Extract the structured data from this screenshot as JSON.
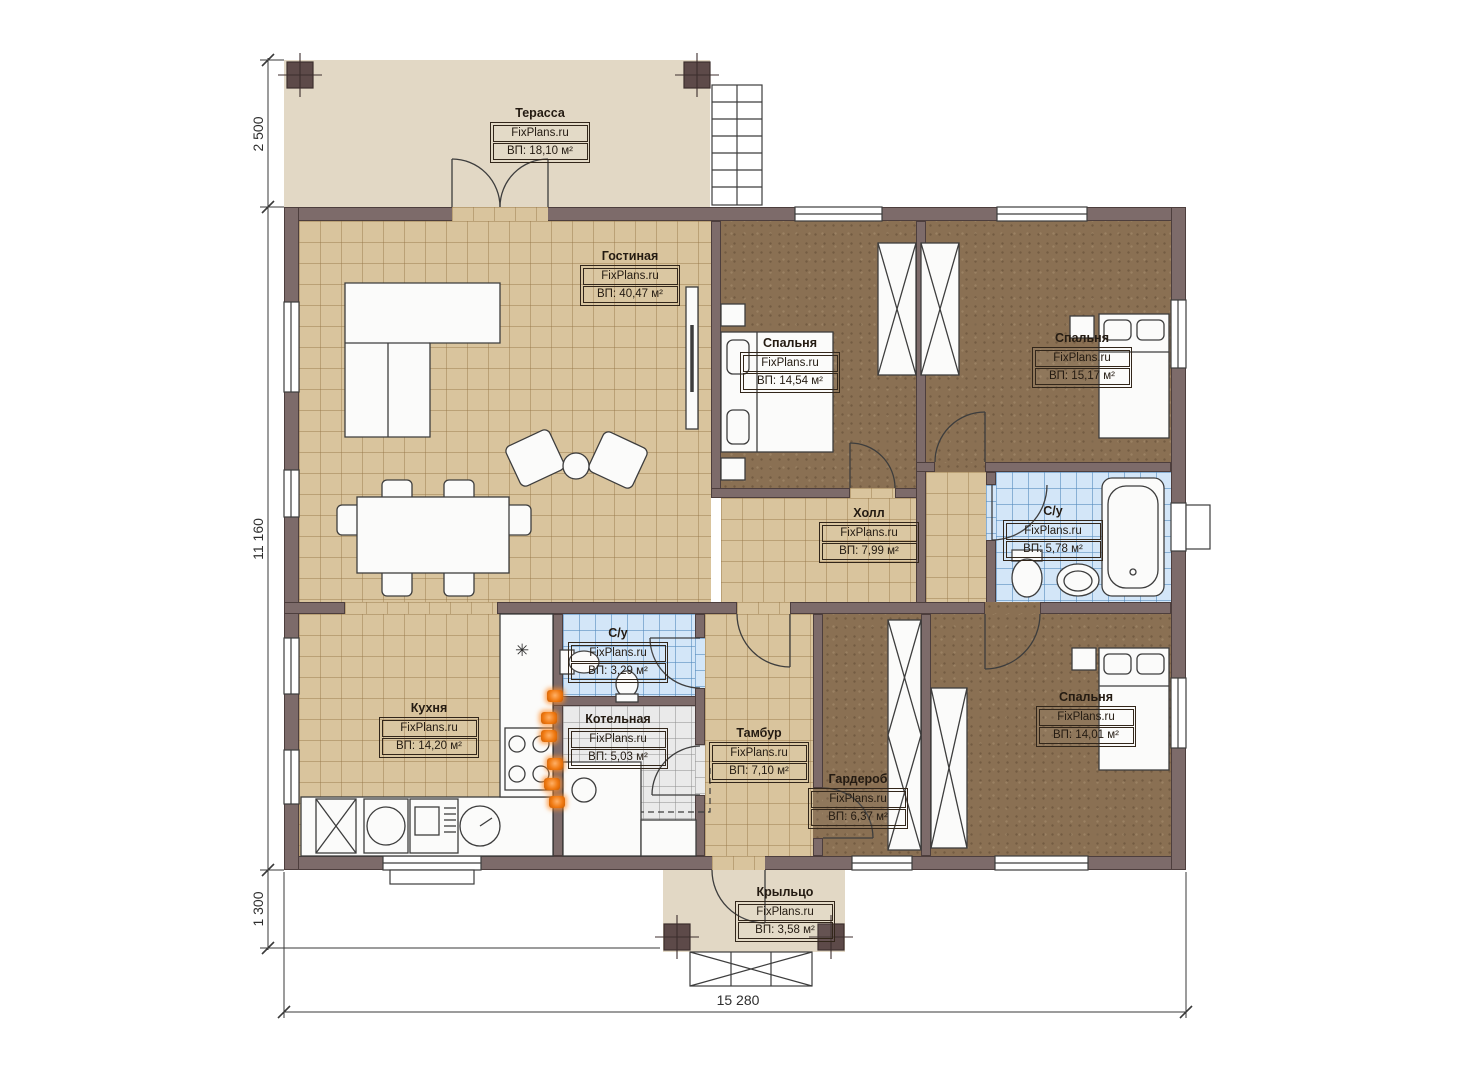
{
  "title": "План одноэтажного дома",
  "brand": "FixPlans.ru",
  "rooms": [
    {
      "name": "Терасса",
      "area": "ВП: 18,10 м²"
    },
    {
      "name": "Гостиная",
      "area": "ВП: 40,47 м²"
    },
    {
      "name": "Спальня",
      "area": "ВП: 14,54 м²"
    },
    {
      "name": "Спальня",
      "area": "ВП: 15,17 м²"
    },
    {
      "name": "С/у",
      "area": "ВП: 5,78 м²"
    },
    {
      "name": "Холл",
      "area": "ВП: 7,99 м²"
    },
    {
      "name": "Кухня",
      "area": "ВП: 14,20 м²"
    },
    {
      "name": "С/у",
      "area": "ВП: 3,29 м²"
    },
    {
      "name": "Котельная",
      "area": "ВП: 5,03 м²"
    },
    {
      "name": "Тамбур",
      "area": "ВП: 7,10 м²"
    },
    {
      "name": "Гардероб",
      "area": "ВП: 6,37 м²"
    },
    {
      "name": "Спальня",
      "area": "ВП: 14,01 м²"
    },
    {
      "name": "Крыльцо",
      "area": "ВП: 3,58 м²"
    }
  ],
  "dimensions": {
    "left_top": "2 500",
    "left_middle": "11 160",
    "left_bottom": "1 300",
    "bottom": "15 280"
  },
  "icons": {
    "fridge": "✳"
  },
  "colors": {
    "wall": "#7d6b6a",
    "floor_tan": "#d9c49d",
    "floor_carpet": "#8a7053",
    "floor_blue": "#d3e6f8",
    "floor_gray": "#eaeaea",
    "deck": "#e2d8c5",
    "marker_orange": "#f07a12",
    "line": "#3d3d3d"
  }
}
